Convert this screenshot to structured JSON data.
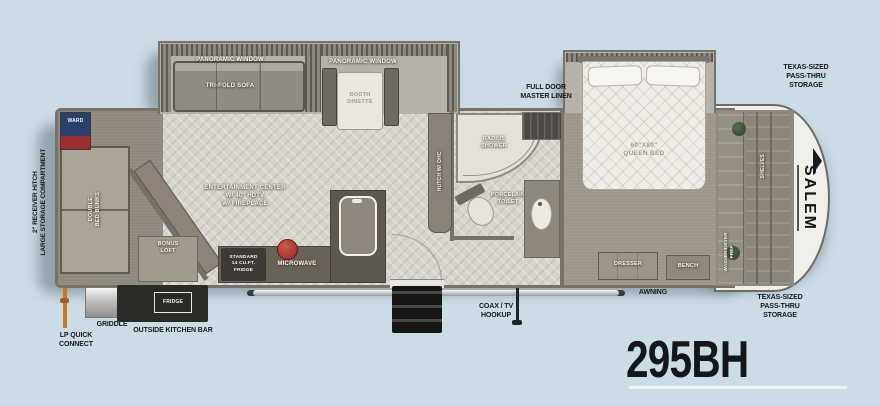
{
  "model_number": "295BH",
  "brand_logo": "SALEM",
  "callouts": {
    "hitch": [
      "2\" RECEIVER HITCH",
      "LARGE STORAGE COMPARTMENT"
    ],
    "lp": [
      "LP QUICK",
      "CONNECT"
    ],
    "griddle": "GRIDDLE",
    "outside_kitchen": "OUTSIDE KITCHEN BAR",
    "coax": [
      "COAX / TV",
      "HOOKUP"
    ],
    "awning": "AWNING",
    "master_linen": [
      "FULL DOOR",
      "MASTER LINEN"
    ],
    "storage_top": [
      "TEXAS-SIZED",
      "PASS-THRU",
      "STORAGE"
    ],
    "storage_bottom": [
      "TEXAS-SIZED",
      "PASS-THRU",
      "STORAGE"
    ]
  },
  "rooms": {
    "window1": "PANORAMIC WINDOW",
    "sofa": "TRI-FOLD SOFA",
    "window2": "PANORAMIC WINDOW",
    "dinette": [
      "BOOTH",
      "DINETTE"
    ],
    "bunks": [
      "DOUBLE",
      "BED BUNKS"
    ],
    "ward": "WARD",
    "loft": [
      "BONUS",
      "LOFT"
    ],
    "entertainment": [
      "ENTERTAINMENT CENTER",
      "W/ 40\" HDTV",
      "W/ FIREPLACE"
    ],
    "fridge": [
      "STANDARD",
      "14 CU.FT.",
      "FRIDGE"
    ],
    "microwave": "MICROWAVE",
    "hutch": "HUTCH W/ OHC",
    "shower": [
      "RADIUS",
      "SHOWER"
    ],
    "toilet": [
      "PORCELAIN",
      "TOILET"
    ],
    "bed": [
      "60\"X80\"",
      "QUEEN BED"
    ],
    "dresser": "DRESSER",
    "bench": "BENCH",
    "shelves": "SHELVES",
    "wd_prep": [
      "WASHER/DRYER",
      "PREP"
    ],
    "outside_fridge": "FRIDGE"
  },
  "colors": {
    "background": "#cbdce6",
    "label": "#17181a",
    "ward_blue": "#2b3f6b",
    "ward_red": "#9c2e30",
    "lp_orange": "#c8791e",
    "kettle_red": "#b23228"
  }
}
